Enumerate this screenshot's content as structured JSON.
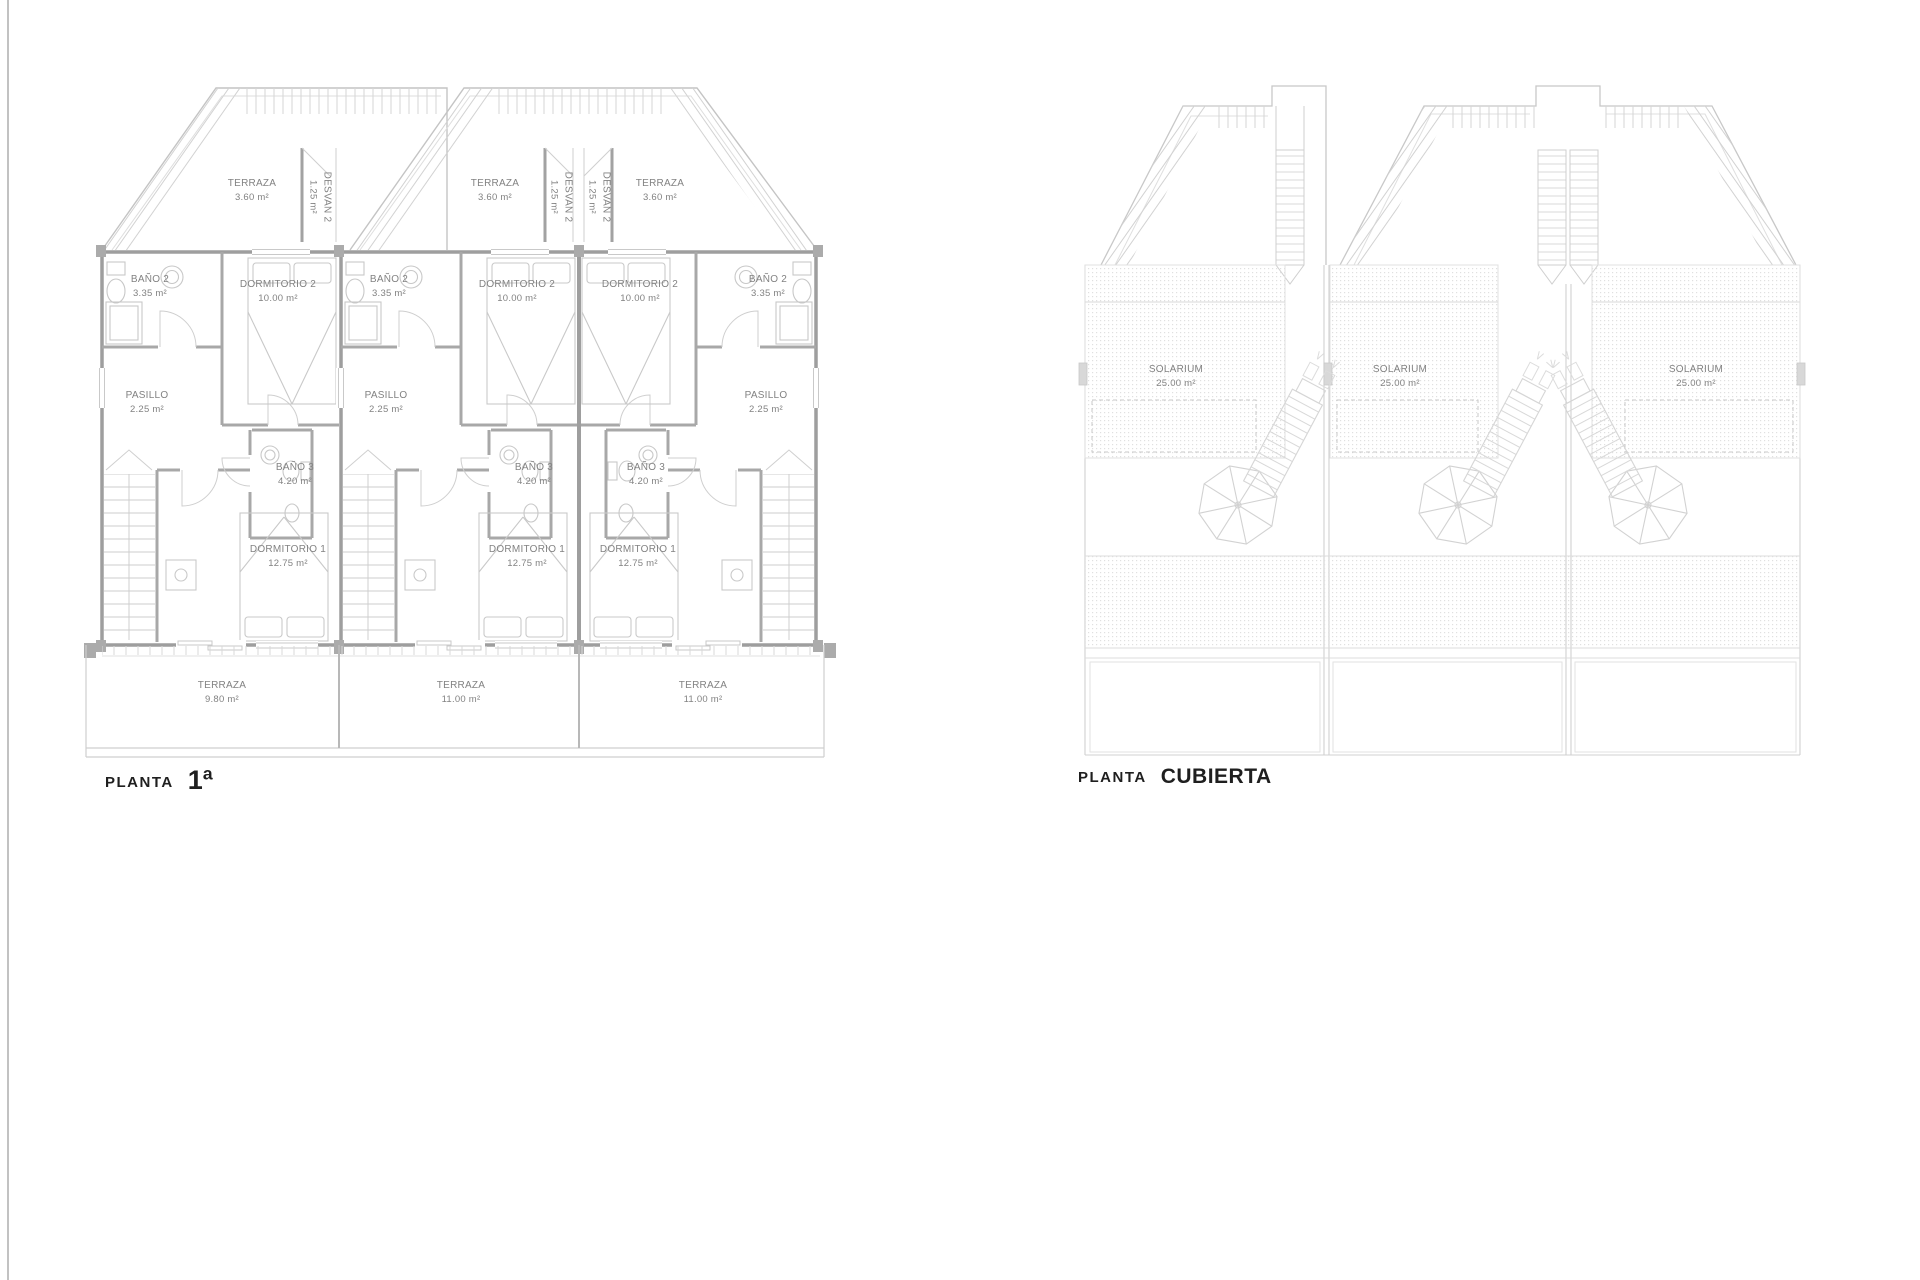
{
  "planta1": {
    "caption": {
      "prefix": "PLANTA",
      "title": "1ª"
    },
    "unit1": {
      "terraza_top": {
        "name": "TERRAZA",
        "area": "3.60 m²"
      },
      "desvan": {
        "name": "DESVAN 2",
        "area": "1.25 m²"
      },
      "bano2": {
        "name": "BAÑO 2",
        "area": "3.35 m²"
      },
      "dormitorio2": {
        "name": "DORMITORIO 2",
        "area": "10.00 m²"
      },
      "pasillo": {
        "name": "PASILLO",
        "area": "2.25 m²"
      },
      "bano3": {
        "name": "BAÑO 3",
        "area": "4.20 m²"
      },
      "dormitorio1": {
        "name": "DORMITORIO 1",
        "area": "12.75 m²"
      },
      "terraza_bottom": {
        "name": "TERRAZA",
        "area": "9.80 m²"
      }
    },
    "unit2": {
      "terraza_top": {
        "name": "TERRAZA",
        "area": "3.60 m²"
      },
      "desvan": {
        "name": "DESVAN 2",
        "area": "1.25 m²"
      },
      "bano2": {
        "name": "BAÑO 2",
        "area": "3.35 m²"
      },
      "dormitorio2": {
        "name": "DORMITORIO 2",
        "area": "10.00 m²"
      },
      "pasillo": {
        "name": "PASILLO",
        "area": "2.25 m²"
      },
      "bano3": {
        "name": "BAÑO 3",
        "area": "4.20 m²"
      },
      "dormitorio1": {
        "name": "DORMITORIO 1",
        "area": "12.75 m²"
      },
      "terraza_bottom": {
        "name": "TERRAZA",
        "area": "11.00 m²"
      }
    },
    "unit3": {
      "terraza_top": {
        "name": "TERRAZA",
        "area": "3.60 m²"
      },
      "desvan": {
        "name": "DESVAN 2",
        "area": "1.25 m²"
      },
      "bano2": {
        "name": "BAÑO 2",
        "area": "3.35 m²"
      },
      "dormitorio2": {
        "name": "DORMITORIO 2",
        "area": "10.00 m²"
      },
      "pasillo": {
        "name": "PASILLO",
        "area": "2.25 m²"
      },
      "bano3": {
        "name": "BAÑO 3",
        "area": "4.20 m²"
      },
      "dormitorio1": {
        "name": "DORMITORIO 1",
        "area": "12.75 m²"
      },
      "terraza_bottom": {
        "name": "TERRAZA",
        "area": "11.00 m²"
      }
    }
  },
  "cubierta": {
    "caption": {
      "prefix": "PLANTA",
      "title": "CUBIERTA"
    },
    "unit1": {
      "solarium": {
        "name": "SOLARIUM",
        "area": "25.00 m²"
      }
    },
    "unit2": {
      "solarium": {
        "name": "SOLARIUM",
        "area": "25.00 m²"
      }
    },
    "unit3": {
      "solarium": {
        "name": "SOLARIUM",
        "area": "25.00 m²"
      }
    }
  }
}
